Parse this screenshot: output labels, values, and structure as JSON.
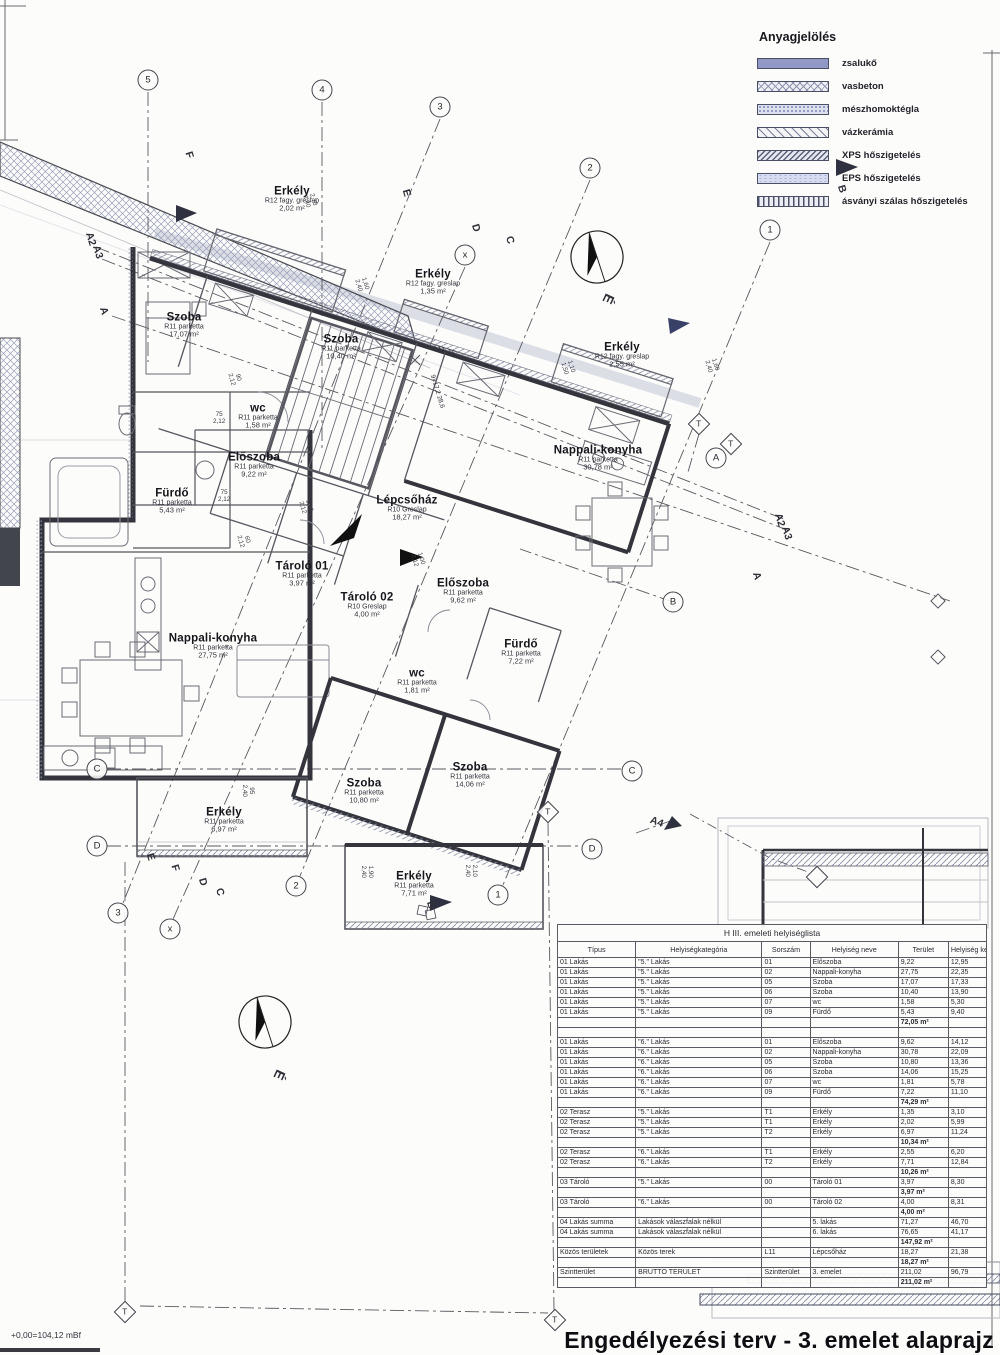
{
  "legend": {
    "title": "Anyagjelölés",
    "items": [
      {
        "label": "zsalukő"
      },
      {
        "label": "vasbeton"
      },
      {
        "label": "mészhomoktégla"
      },
      {
        "label": "vázkerámia"
      },
      {
        "label": "XPS hőszigetelés"
      },
      {
        "label": "EPS hőszigetelés"
      },
      {
        "label": "ásványi szálas hőszigetelés"
      }
    ]
  },
  "plan": {
    "rooms": [
      {
        "name": "Erkély",
        "finish": "R12 fagy. greslap",
        "area": "2,02 m²"
      },
      {
        "name": "Erkély",
        "finish": "R12 fagy. greslap",
        "area": "1,35 m²"
      },
      {
        "name": "Erkély",
        "finish": "R12 fagy. greslap",
        "area": "2,55 m²"
      },
      {
        "name": "Szoba",
        "finish": "R11 parketta",
        "area": "17,07 m²"
      },
      {
        "name": "Szoba",
        "finish": "R11 parketta",
        "area": "10,40 m²"
      },
      {
        "name": "wc",
        "finish": "R11 parketta",
        "area": "1,58 m²"
      },
      {
        "name": "Előszoba",
        "finish": "R11 parketta",
        "area": "9,22 m²"
      },
      {
        "name": "Fürdő",
        "finish": "R11 parketta",
        "area": "5,43 m²"
      },
      {
        "name": "Nappali-konyha",
        "finish": "R11 parketta",
        "area": "30,78 m²"
      },
      {
        "name": "Lépcsőház",
        "finish": "R10 Greslap",
        "area": "18,27 m²"
      },
      {
        "name": "Tároló 01",
        "finish": "R11 parketta",
        "area": "3,97 m²"
      },
      {
        "name": "Tároló 02",
        "finish": "R10 Greslap",
        "area": "4,00 m²"
      },
      {
        "name": "Előszoba",
        "finish": "R11 parketta",
        "area": "9,62 m²"
      },
      {
        "name": "Nappali-konyha",
        "finish": "R11 parketta",
        "area": "27,75 m²"
      },
      {
        "name": "Fürdő",
        "finish": "R11 parketta",
        "area": "7,22 m²"
      },
      {
        "name": "wc",
        "finish": "R11 parketta",
        "area": "1,81 m²"
      },
      {
        "name": "Szoba",
        "finish": "R11 parketta",
        "area": "10,80 m²"
      },
      {
        "name": "Szoba",
        "finish": "R11 parketta",
        "area": "14,06 m²"
      },
      {
        "name": "Erkély",
        "finish": "R11 parketta",
        "area": "6,97 m²"
      },
      {
        "name": "Erkély",
        "finish": "R11 parketta",
        "area": "7,71 m²"
      }
    ],
    "circle_markers": [
      "5",
      "4",
      "3",
      "2",
      "1",
      "x",
      "A",
      "B",
      "C",
      "C",
      "D",
      "D",
      "3",
      "x",
      "2",
      "1"
    ],
    "diamond_markers": [
      "T",
      "T",
      "T",
      "T",
      "T",
      ""
    ],
    "letters": [
      "F",
      "E",
      "D",
      "C",
      "A2",
      "A3",
      "A",
      "B",
      "A2",
      "A3",
      "A",
      "É",
      "A4",
      "E",
      "F",
      "D",
      "C",
      "B",
      "É"
    ],
    "dims": [
      [
        "2,70",
        "2,40"
      ],
      [
        "1,60",
        "2,40"
      ],
      [
        "1,10",
        "1,50"
      ],
      [
        "1,60",
        "2,40"
      ],
      [
        "75",
        "2,12"
      ],
      [
        "75",
        "2,12"
      ],
      [
        "90",
        "2,12"
      ],
      [
        "60",
        "2,12"
      ],
      [
        "1,00",
        "2,12"
      ],
      [
        "1,00",
        "2,12"
      ],
      [
        "1,90",
        "2,40"
      ],
      [
        "2,10",
        "2,40"
      ],
      [
        "95",
        "2,40"
      ]
    ],
    "level_mark": "+11,15",
    "stair_note_1": "9×17,2",
    "stair_note_2": "28,6",
    "datum": "+0,00=104,12 mBf"
  },
  "table": {
    "title": "H III. emeleti helyiséglista",
    "headers": [
      "Típus",
      "Helyiségkategória",
      "Sorszám",
      "Helyiség neve",
      "Terület",
      "Helyiség kerül."
    ],
    "rows": [
      {
        "c": [
          "01 Lakás",
          "\"5.\" Lakás",
          "01",
          "Előszoba",
          "9,22",
          "12,95"
        ]
      },
      {
        "c": [
          "01 Lakás",
          "\"5.\" Lakás",
          "02",
          "Nappali-konyha",
          "27,75",
          "22,35"
        ]
      },
      {
        "c": [
          "01 Lakás",
          "\"5.\" Lakás",
          "05",
          "Szoba",
          "17,07",
          "17,33"
        ]
      },
      {
        "c": [
          "01 Lakás",
          "\"5.\" Lakás",
          "06",
          "Szoba",
          "10,40",
          "13,90"
        ]
      },
      {
        "c": [
          "01 Lakás",
          "\"5.\" Lakás",
          "07",
          "wc",
          "1,58",
          "5,30"
        ]
      },
      {
        "c": [
          "01 Lakás",
          "\"5.\" Lakás",
          "09",
          "Fürdő",
          "5,43",
          "9,40"
        ]
      },
      {
        "sum": "72,05 m²"
      },
      {
        "c": [
          "",
          "",
          "",
          "",
          "",
          ""
        ]
      },
      {
        "c": [
          "01 Lakás",
          "\"6.\" Lakás",
          "01",
          "Előszoba",
          "9,62",
          "14,12"
        ]
      },
      {
        "c": [
          "01 Lakás",
          "\"6.\" Lakás",
          "02",
          "Nappali-konyha",
          "30,78",
          "22,09"
        ]
      },
      {
        "c": [
          "01 Lakás",
          "\"6.\" Lakás",
          "05",
          "Szoba",
          "10,80",
          "13,36"
        ]
      },
      {
        "c": [
          "01 Lakás",
          "\"6.\" Lakás",
          "06",
          "Szoba",
          "14,06",
          "15,25"
        ]
      },
      {
        "c": [
          "01 Lakás",
          "\"6.\" Lakás",
          "07",
          "wc",
          "1,81",
          "5,78"
        ]
      },
      {
        "c": [
          "01 Lakás",
          "\"6.\" Lakás",
          "09",
          "Fürdő",
          "7,22",
          "11,10"
        ]
      },
      {
        "sum": "74,29 m²"
      },
      {
        "c": [
          "02 Terasz",
          "\"5.\" Lakás",
          "T1",
          "Erkély",
          "1,35",
          "3,10"
        ]
      },
      {
        "c": [
          "02 Terasz",
          "\"5.\" Lakás",
          "T1",
          "Erkély",
          "2,02",
          "5,99"
        ]
      },
      {
        "c": [
          "02 Terasz",
          "\"5.\" Lakás",
          "T2",
          "Erkély",
          "6,97",
          "11,24"
        ]
      },
      {
        "sum": "10,34 m²"
      },
      {
        "c": [
          "02 Terasz",
          "\"6.\" Lakás",
          "T1",
          "Erkély",
          "2,55",
          "6,20"
        ]
      },
      {
        "c": [
          "02 Terasz",
          "\"6.\" Lakás",
          "T2",
          "Erkély",
          "7,71",
          "12,84"
        ]
      },
      {
        "sum": "10,26 m²"
      },
      {
        "c": [
          "03 Tároló",
          "\"5.\" Lakás",
          "00",
          "Tároló 01",
          "3,97",
          "8,30"
        ]
      },
      {
        "sum": "3,97 m²"
      },
      {
        "c": [
          "03 Tároló",
          "\"6.\" Lakás",
          "00",
          "Tároló 02",
          "4,00",
          "8,31"
        ]
      },
      {
        "sum": "4,00 m²"
      },
      {
        "c": [
          "04 Lakás summa",
          "Lakások válaszfalak nélkül",
          "",
          "5. lakás",
          "71,27",
          "46,70"
        ]
      },
      {
        "c": [
          "04 Lakás summa",
          "Lakások válaszfalak nélkül",
          "",
          "6. lakás",
          "76,65",
          "41,17"
        ]
      },
      {
        "sum": "147,92 m²"
      },
      {
        "c": [
          "Közös területek",
          "Közös terek",
          "L11",
          "Lépcsőház",
          "18,27",
          "21,38"
        ]
      },
      {
        "sum": "18,27 m²"
      },
      {
        "c": [
          "Szintterület",
          "BRUTTÓ TERÜLET",
          "Szintterület",
          "3. emelet",
          "211,02",
          "96,79"
        ]
      },
      {
        "sum": "211,02 m²"
      }
    ]
  },
  "footer": {
    "title": "Engedélyezési terv - 3. emelet alaprajz"
  }
}
